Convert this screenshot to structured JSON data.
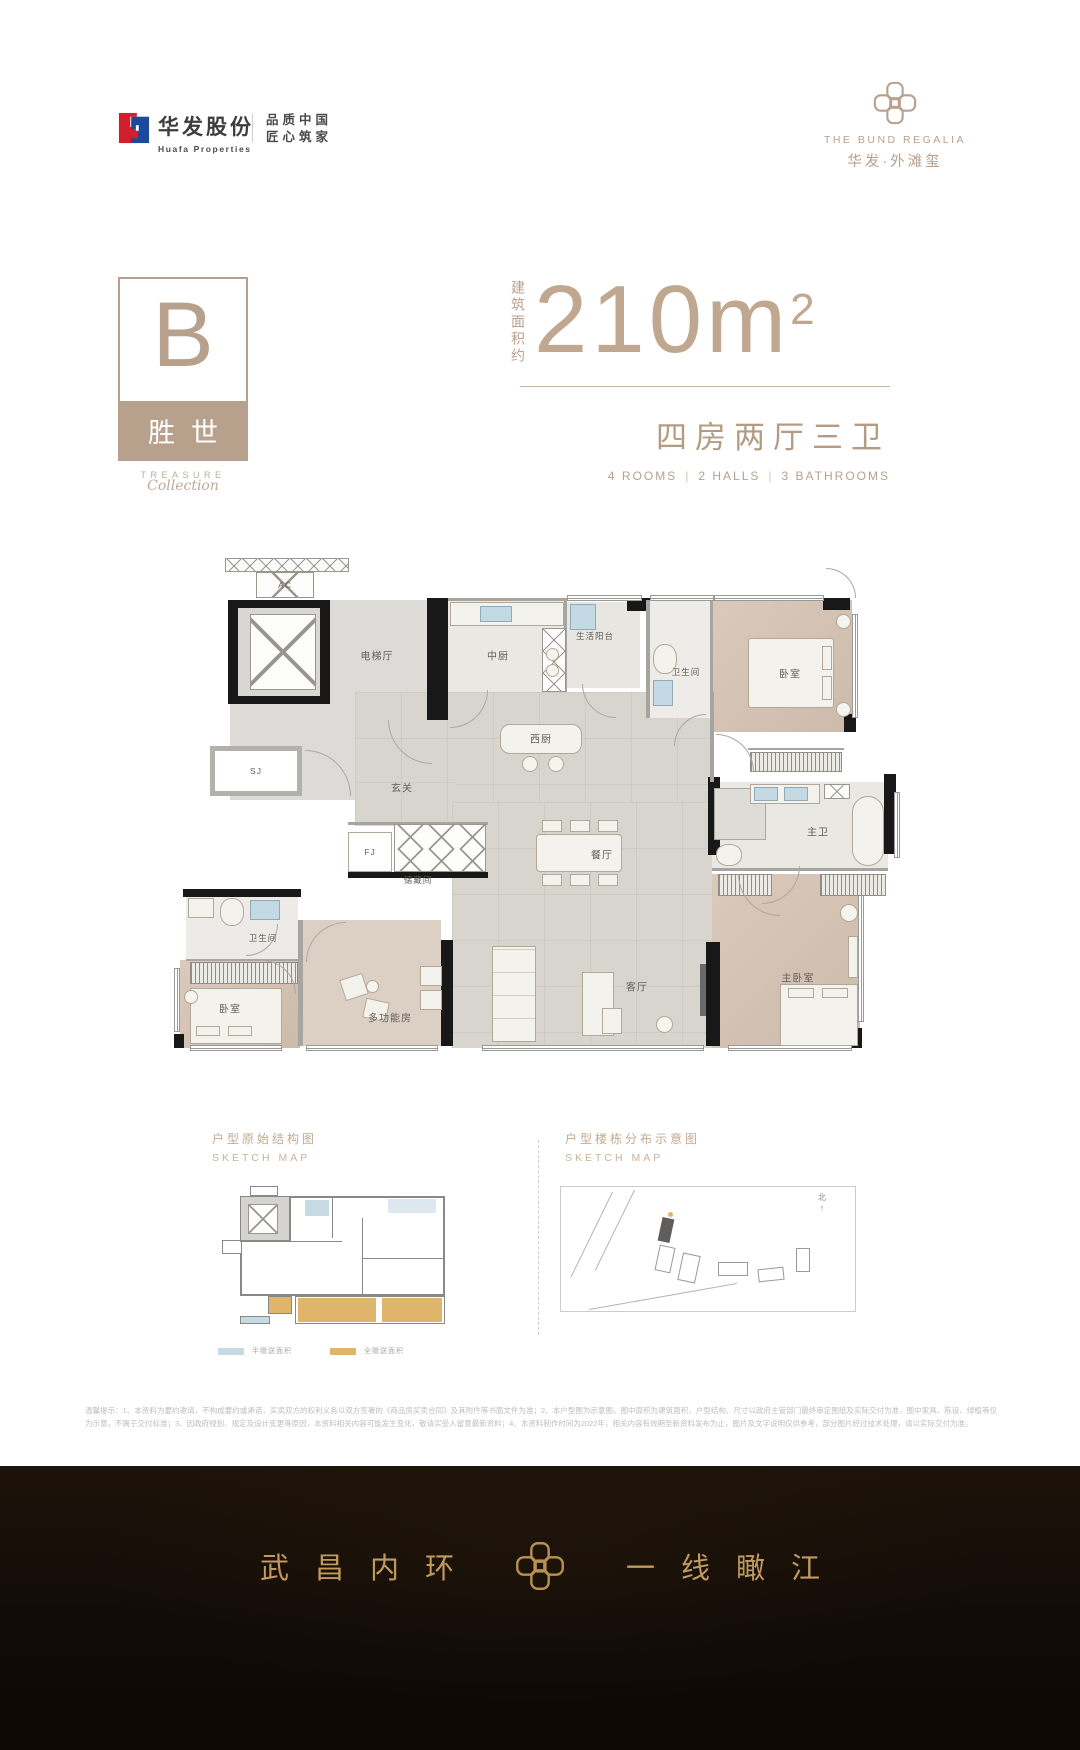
{
  "header": {
    "huafa": {
      "cn": "华发股份",
      "en": "Huafa Properties",
      "slogan1": "品质中国",
      "slogan2": "匠心筑家"
    },
    "brand": {
      "en": "THE BUND REGALIA",
      "cn": "华发·外滩玺"
    }
  },
  "unit": {
    "letter": "B",
    "name": "胜世",
    "series1": "TREASURE",
    "series2": "Collection"
  },
  "area": {
    "label": "建筑面积约",
    "value": "210m",
    "sup": "2"
  },
  "layout": {
    "cn": "四房两厅三卫",
    "en1": "4 ROOMS",
    "en2": "2 HALLS",
    "en3": "3 BATHROOMS",
    "sep": "|"
  },
  "floorplan": {
    "labels": {
      "ac": "AC",
      "sj": "SJ",
      "fj": "FJ",
      "elevator_hall": "电梯厅",
      "cn_kitchen": "中厨",
      "life_balcony": "生活阳台",
      "bath_top": "卫生间",
      "bedroom_top": "卧室",
      "w_kitchen": "西厨",
      "foyer": "玄关",
      "storage": "储藏间",
      "dining": "餐厅",
      "master_bath": "主卫",
      "living": "客厅",
      "multi_room": "多功能房",
      "bedroom_bl": "卧室",
      "master_bedroom": "主卧室"
    }
  },
  "sketch_left": {
    "title_cn": "户型原始结构图",
    "title_en": "SKETCH MAP",
    "legend1": {
      "color": "#c6dae4",
      "label": "半赠送面积"
    },
    "legend2": {
      "color": "#dfb56c",
      "label": "全赠送面积"
    }
  },
  "sketch_right": {
    "title_cn": "户型楼栋分布示意图",
    "title_en": "SKETCH MAP",
    "north": "北"
  },
  "disclaimer": "温馨提示：1、本资料为要约邀请，不构成要约或承诺，买卖双方的权利义务以双方签署的《商品房买卖合同》及其附件等书面文件为准；2、本户型图为示意图，图中面积为建筑面积，户型结构、尺寸以政府主管部门最终审定图纸及实际交付为准，图中家具、陈设、绿植等仅为示意，不属于交付标准；3、因政府规划、规定及设计变更等原因，本资料相关内容可能发生变化，敬请买受人留意最新资料；4、本资料制作时间为2022年，相关内容有效期至新资料发布为止，图片及文字说明仅供参考，部分图片经过技术处理，请以实际交付为准。",
  "footer": {
    "left": "武昌内环",
    "right": "一线瞰江"
  }
}
